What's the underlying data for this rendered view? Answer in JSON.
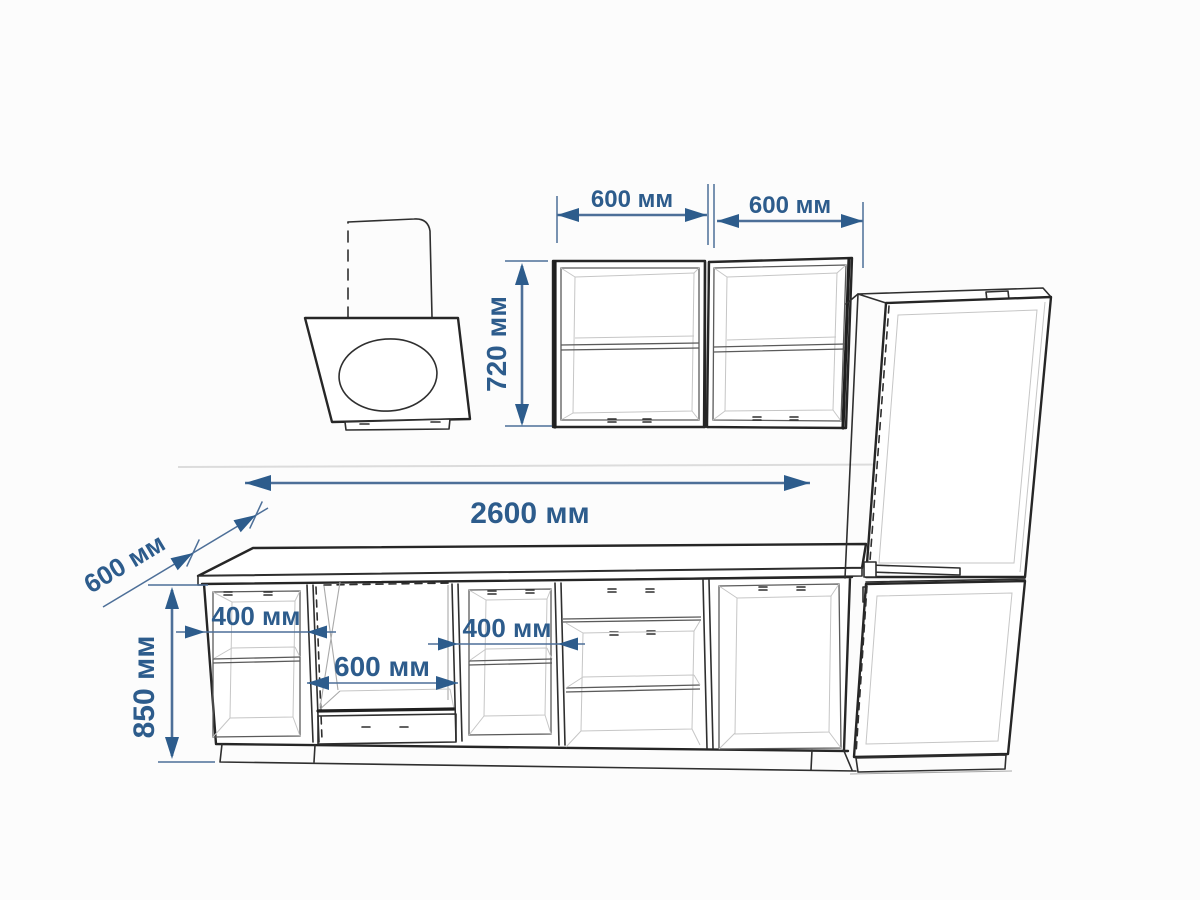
{
  "diagram": {
    "type": "kitchen-furniture-dimension-drawing",
    "dimensions": {
      "wall_cabinet_left_width": "600 мм",
      "wall_cabinet_right_width": "600 мм",
      "wall_cabinet_height": "720 мм",
      "countertop_length": "2600 мм",
      "countertop_depth": "600 мм",
      "base_cabinet_height": "850 мм",
      "base_cabinet_left_width": "400 мм",
      "oven_niche_width": "600 мм",
      "base_cabinet_mid_width": "400 мм"
    },
    "colors": {
      "dimension_text": "#2d5c8c",
      "dimension_line": "#4d6f98",
      "outline": "#2f2f2f",
      "light_line": "#a9a9a9",
      "background": "#fcfcfc"
    }
  }
}
